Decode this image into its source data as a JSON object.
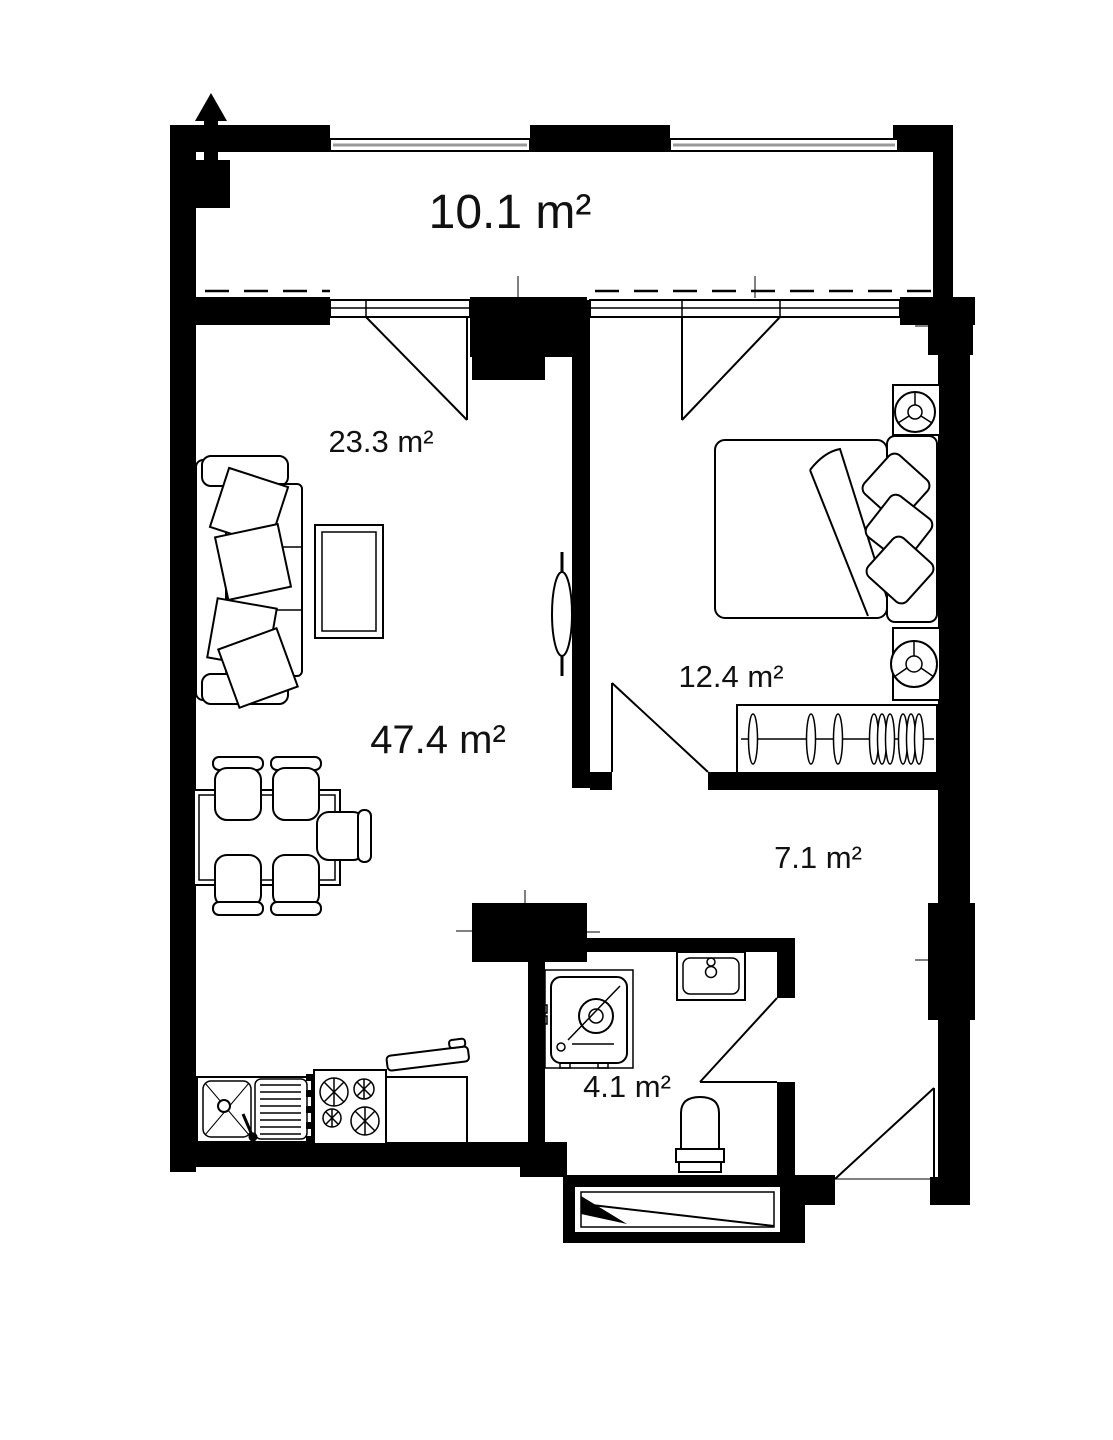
{
  "plan": {
    "type": "apartment-floor-plan",
    "rooms": {
      "balcony": {
        "area_label": "10.1 m²"
      },
      "living_zone": {
        "area_label": "23.3 m²"
      },
      "living_kitchen_total": {
        "area_label": "47.4 m²"
      },
      "bedroom": {
        "area_label": "12.4 m²"
      },
      "hallway": {
        "area_label": "7.1 m²"
      },
      "bathroom": {
        "area_label": "4.1 m²"
      }
    },
    "colors": {
      "wall": "#000000",
      "background": "#ffffff",
      "parapet_gray": "#9a9a9a"
    }
  }
}
